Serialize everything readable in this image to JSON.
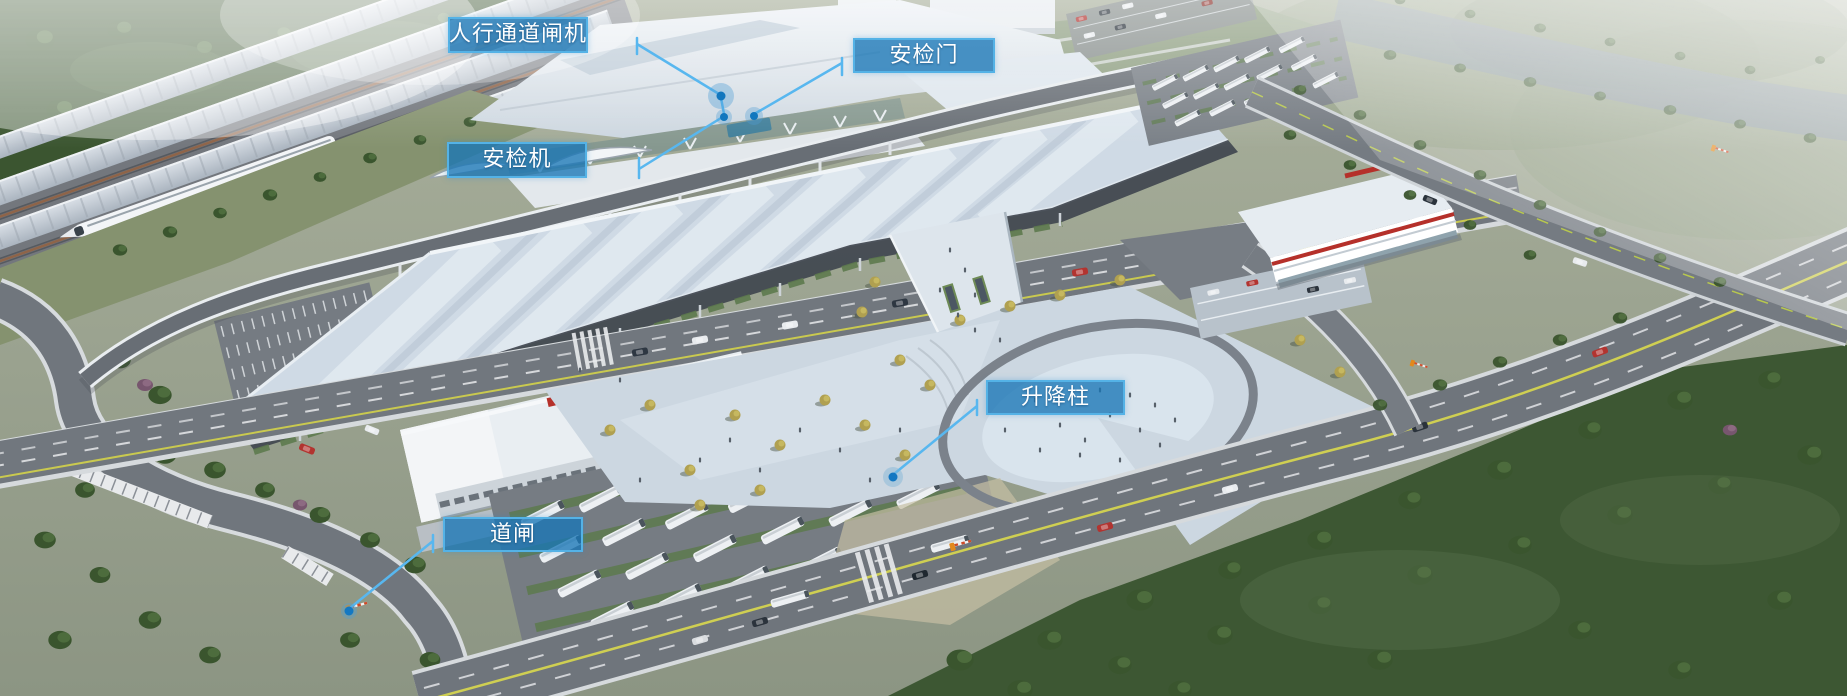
{
  "scene": {
    "description": "Aerial architectural rendering of a high-speed railway station: train platforms top-left, large striped canopy over the station front road, pedestrian plaza with U-shaped loop, bus and car parking lots, surrounding roads and forest, hazy river top-right.",
    "annotation_style": {
      "callout_bg": "#1876b6",
      "callout_border": "#54b2e6",
      "callout_text_color": "#ffffff",
      "leader_color": "#58b7ef",
      "dot_color": "#1277be"
    }
  },
  "callouts": [
    {
      "id": "pedestrian-channel-gate",
      "label": "人行通道闸机"
    },
    {
      "id": "security-door",
      "label": "安检门"
    },
    {
      "id": "security-scanner",
      "label": "安检机"
    },
    {
      "id": "lifting-bollard",
      "label": "升降柱"
    },
    {
      "id": "barrier-gate",
      "label": "道闸"
    }
  ]
}
